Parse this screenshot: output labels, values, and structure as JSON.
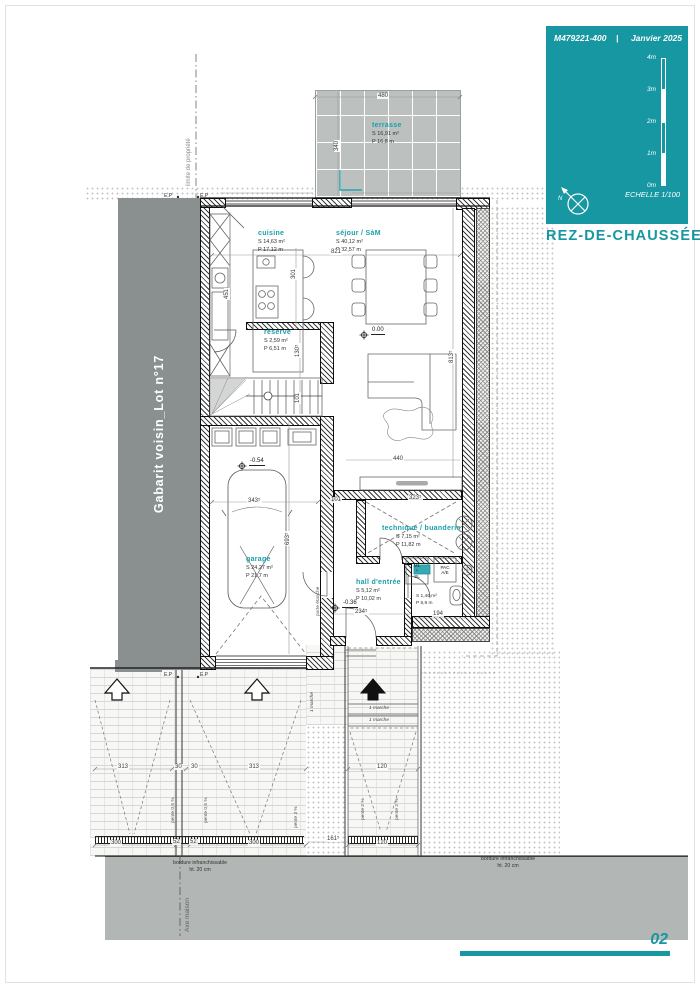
{
  "colors": {
    "accent": "#1697A1",
    "band_grey": "#8A9090",
    "tile_grey": "#BCC0C0",
    "road_grey": "#B2B6B5"
  },
  "title_block": {
    "ref": "M479221-400",
    "sep": "|",
    "date": "Janvier 2025",
    "scale_marks": [
      "4m",
      "3m",
      "2m",
      "1m",
      "0m"
    ],
    "scale_caption": "ECHELLE  1/100",
    "north": "N",
    "floor_title": "REZ-DE-CHAUSSÉE"
  },
  "page": {
    "number": "02"
  },
  "site": {
    "neighbor_band": "Gabarit voisin_Lot n°17",
    "property_line": "limite de propriété",
    "house_axis": "Axe maison",
    "ep": "E.P",
    "curb_note_1": "bordure infranchissable",
    "curb_note_2": "ht. 20 cm",
    "step_note": "1 marche",
    "slope_05": "pente 0,5 %",
    "slope_3": "pente 3 %",
    "slope_2": "pente 2 %",
    "door_note": "porte étanche"
  },
  "rooms": {
    "terrasse": {
      "name": "terrasse",
      "s": "S  16,91 m²",
      "p": "P  16,8 m"
    },
    "cuisine": {
      "name": "cuisine",
      "s": "S  14,63 m²",
      "p": "P  17,12 m"
    },
    "sejour": {
      "name": "séjour / SàM",
      "s": "S  40,12 m²",
      "p": "P  32,57 m"
    },
    "reserve": {
      "name": "réserve",
      "s": "S  2,59 m²",
      "p": "P  6,51 m"
    },
    "garage": {
      "name": "garage",
      "s": "S  24,27 m²",
      "p": "P  21,7 m"
    },
    "technique": {
      "name": "technique / buanderie",
      "s": "S  7,15 m²",
      "p": "P  11,82 m"
    },
    "hall": {
      "name": "hall d'entrée",
      "s": "S  5,12 m²",
      "p": "P  10,02 m"
    },
    "wc": {
      "s": "S  1,46 m²",
      "p": "P  5,9 m"
    }
  },
  "levels": {
    "sejour": "0.00",
    "garage": "-0.54",
    "hall": "-0.36"
  },
  "equipment": {
    "ml_1": "ML",
    "ml_2": "+",
    "ml_3": "SL",
    "pac_1": "PAC",
    "pac_2": "A/E"
  },
  "dims": {
    "terr_w": "480",
    "terr_h": "340",
    "sej_w": "821",
    "cui_h": "451",
    "isl": "301",
    "res_h": "130⁵",
    "stair": "101",
    "sej_l": "440",
    "sej_h": "813⁵",
    "gar_w": "343⁵",
    "gar_h": "693⁵",
    "tech_w": "323⁵",
    "tech_gap": "101",
    "hall_w": "234⁵",
    "wc_w": "194",
    "drv_l": "313",
    "strip_a": "30",
    "strip_b": "30",
    "drv_r": "313",
    "path_w": "120",
    "apr_l": "300",
    "curb_a": "52",
    "curb_b": "52",
    "apr_r": "300",
    "path_l": "161⁵",
    "path_b": "120"
  }
}
